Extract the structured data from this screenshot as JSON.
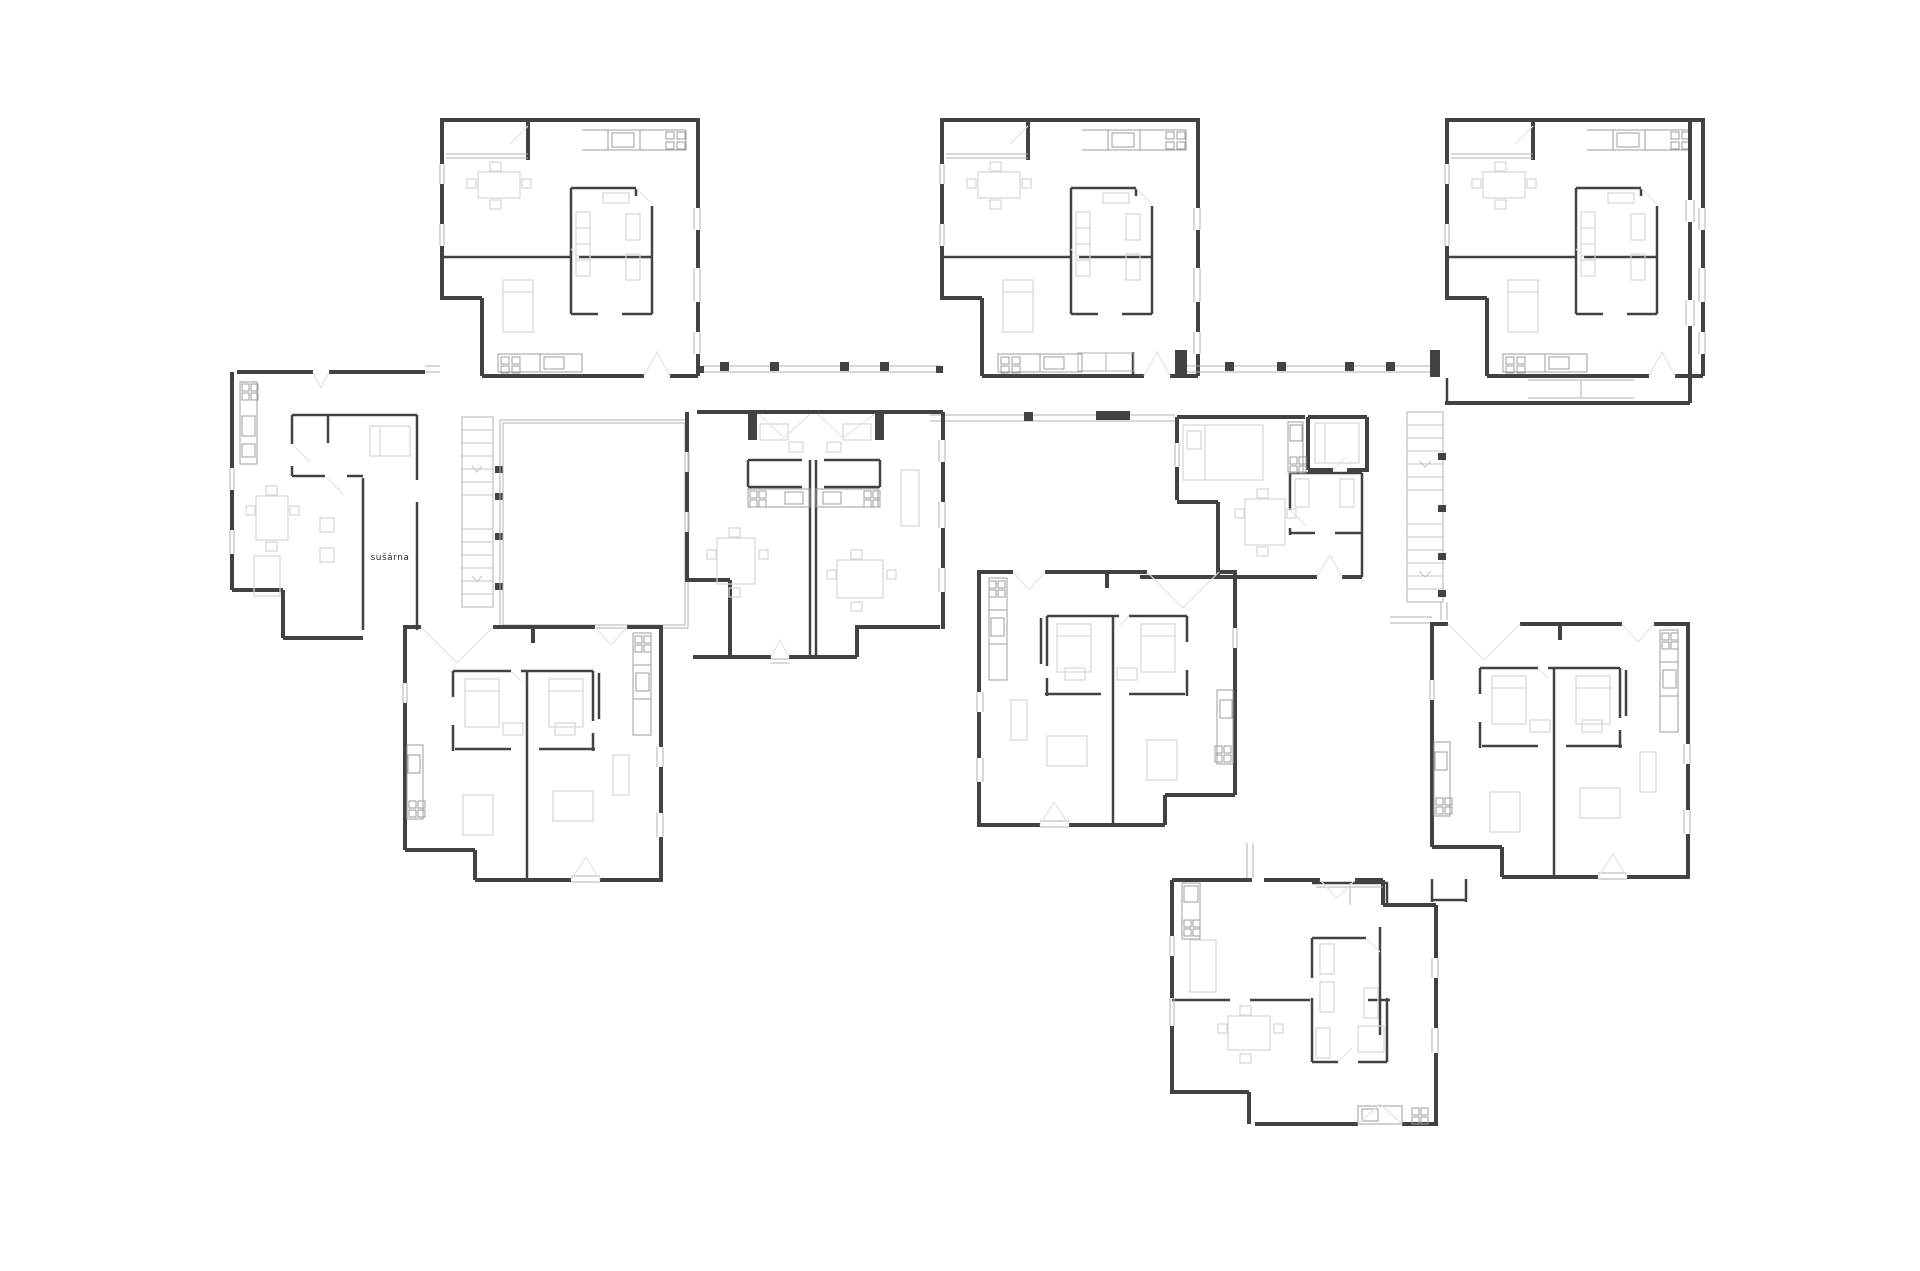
{
  "labels": {
    "drying_room": "sušárna"
  },
  "palette": {
    "background": "#ffffff",
    "wall": "#424242",
    "window": "#b2b2b2",
    "furniture": "#d6d6d6",
    "fixture": "#9e9e9e",
    "door_swing": "#e3e3e3",
    "stair": "#c4c4c4",
    "text": "#2b2b2b"
  },
  "plan": {
    "units": [
      "unit-top-left",
      "unit-top-middle",
      "unit-top-right",
      "unit-west",
      "unit-center-double",
      "unit-center-east",
      "unit-lower-west",
      "unit-lower-middle",
      "unit-lower-east",
      "unit-south"
    ],
    "stairs": [
      "stair-west",
      "stair-east"
    ],
    "courtyards": [
      "courtyard-west",
      "courtyard-east"
    ],
    "corridors": [
      "gallery-top-west",
      "gallery-top-mid",
      "gallery-top-east",
      "gallery-center",
      "link-east",
      "link-south"
    ]
  }
}
